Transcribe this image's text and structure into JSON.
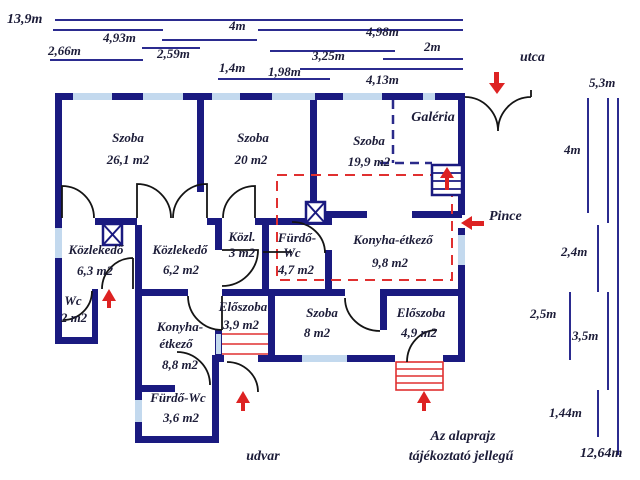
{
  "colors": {
    "wall": "#1a1a80",
    "window": "#c3d9ee",
    "dimension_line": "#2b2b8f",
    "accent_red": "#dd2222",
    "text": "#1c1c38",
    "background": "#ffffff"
  },
  "top_dims": {
    "d13_9": "13,9m",
    "d4_93": "4,93m",
    "d2_66": "2,66m",
    "d2_59": "2,59m",
    "d4": "4m",
    "d1_4": "1,4m",
    "d1_98": "1,98m",
    "d3_25": "3,25m",
    "d4_98": "4,98m",
    "d2": "2m",
    "d4_13": "4,13m"
  },
  "right_dims": {
    "d5_3": "5,3m",
    "d4": "4m",
    "d2_4": "2,4m",
    "d2_5": "2,5m",
    "d3_5": "3,5m",
    "d1_44": "1,44m",
    "d12_64": "12,64m"
  },
  "labels": {
    "street": "utca",
    "courtyard": "udvar",
    "gallery": "Galéria",
    "cellar": "Pince"
  },
  "rooms": {
    "szoba1": {
      "name": "Szoba",
      "area": "26,1 m2"
    },
    "szoba2": {
      "name": "Szoba",
      "area": "20 m2"
    },
    "szoba3": {
      "name": "Szoba",
      "area": "19,9 m2"
    },
    "kozlekedo1": {
      "name": "Közlekedő",
      "area": "6,3 m2"
    },
    "kozlekedo2": {
      "name": "Közlekedő",
      "area": "6,2 m2"
    },
    "kozl3": {
      "name": "Közl.",
      "area": "3 m2"
    },
    "furdo47": {
      "line1": "Fürdő-",
      "line2": "Wc",
      "area": "4,7 m2"
    },
    "konyha98": {
      "name": "Konyha-étkező",
      "area": "9,8 m2"
    },
    "wc2": {
      "name": "Wc",
      "area": "2 m2"
    },
    "konyha88": {
      "line1": "Konyha-",
      "line2": "étkező",
      "area": "8,8 m2"
    },
    "eloszoba39": {
      "name": "Előszoba",
      "area": "3,9 m2"
    },
    "szoba8": {
      "name": "Szoba",
      "area": "8 m2"
    },
    "eloszoba49": {
      "name": "Előszoba",
      "area": "4,9 m2"
    },
    "furdo36": {
      "name": "Fürdő-Wc",
      "area": "3,6 m2"
    }
  },
  "note": {
    "line1": "Az alaprajz",
    "line2": "tájékoztató jellegű"
  }
}
